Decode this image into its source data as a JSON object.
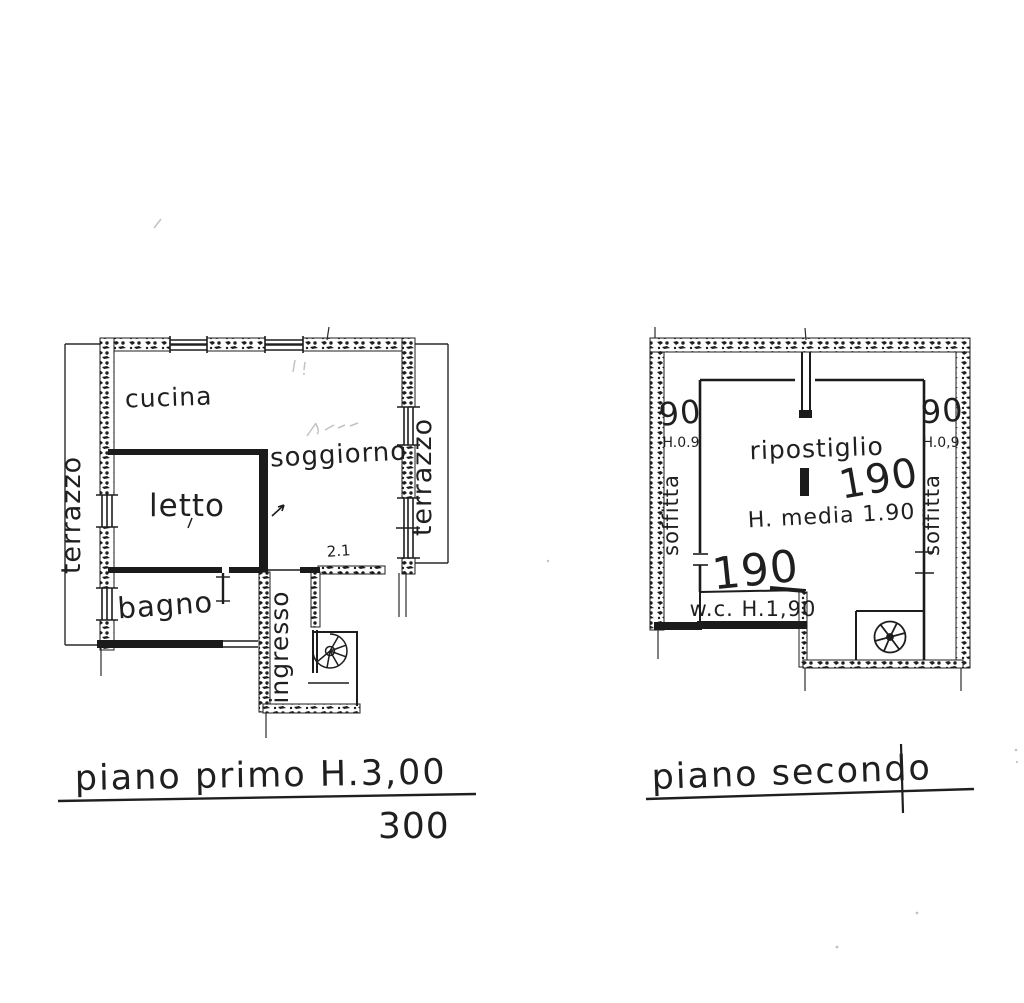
{
  "colors": {
    "ink": "#1f1f1f",
    "paper": "#ffffff"
  },
  "first_floor_plan": {
    "caption": "piano primo H.3,00",
    "caption_dimension": "300",
    "room_labels": {
      "cucina": "cucina",
      "soggiorno": "soggiorno",
      "letto": "letto",
      "bagno": "bagno",
      "ingresso": "ingresso",
      "terrazzo_left": "terrazzo",
      "terrazzo_right": "terrazzo"
    },
    "annotations": {
      "pencil_note": "2.1"
    }
  },
  "second_floor_plan": {
    "caption": "piano secondo",
    "room_labels": {
      "ripostiglio": "ripostiglio",
      "height_note": "H. media 1.90",
      "wc": "w.c. H.1,90",
      "dimension_upper": "190",
      "dimension_lower": "190",
      "soffitta_left": {
        "width": "90",
        "height": "H.0.9",
        "label": "soffitta"
      },
      "soffitta_right": {
        "width": "90",
        "height": "H.0,9",
        "label": "soffitta"
      }
    }
  }
}
